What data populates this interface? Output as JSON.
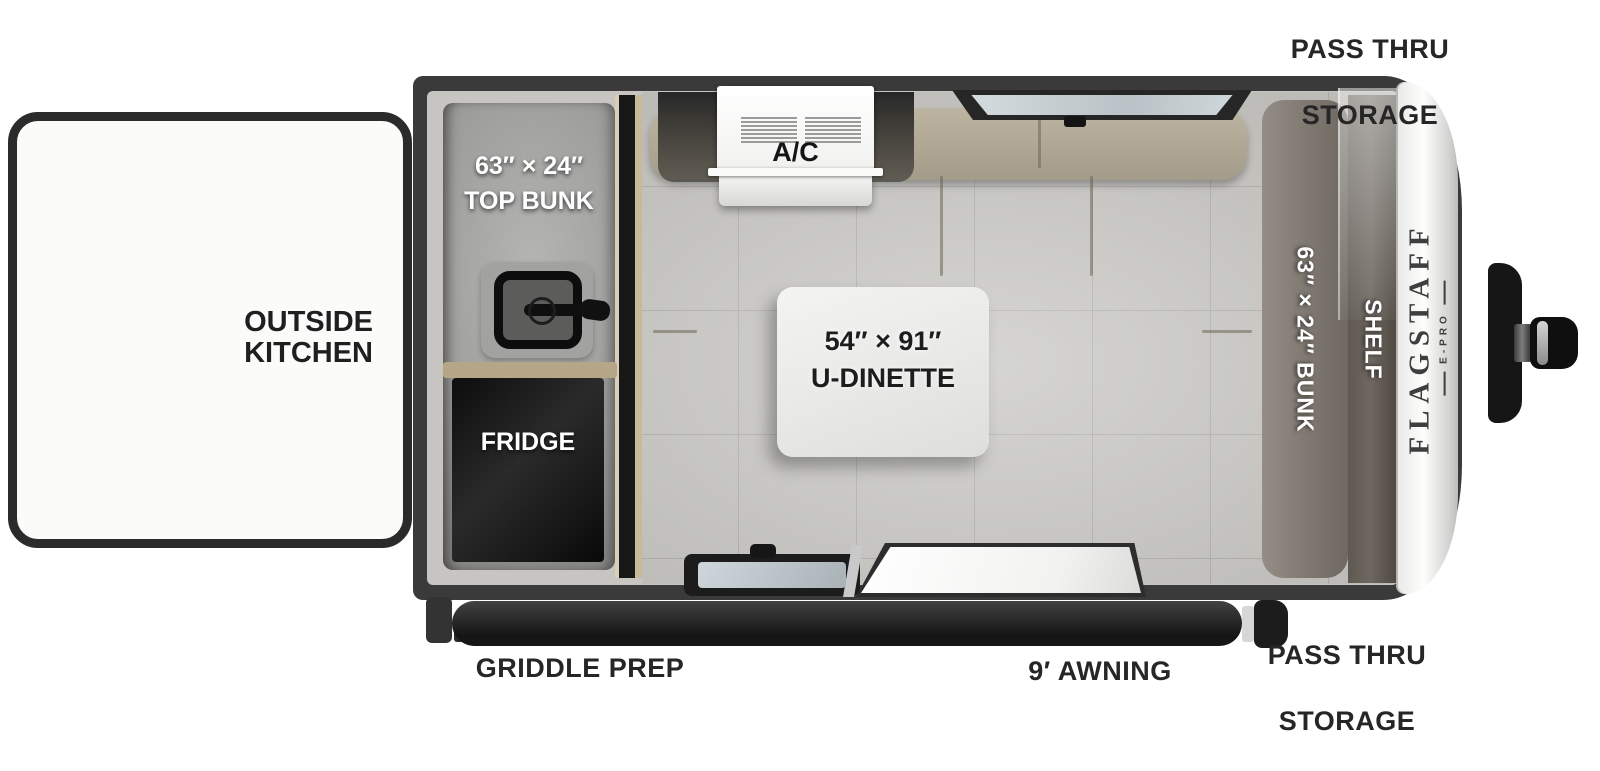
{
  "diagram": {
    "type": "rv-floorplan",
    "brand": {
      "name": "FLAGSTAFF",
      "model": "E-PRO"
    },
    "labels": {
      "pass_thru_top_l1": "PASS THRU",
      "pass_thru_top_l2": "STORAGE",
      "outside_kitchen_l1": "OUTSIDE",
      "outside_kitchen_l2": "KITCHEN",
      "top_bunk_l1": "63″ × 24″",
      "top_bunk_l2": "TOP BUNK",
      "fridge": "FRIDGE",
      "ac": "A/C",
      "dinette_l1": "54″ × 91″",
      "dinette_l2": "U-DINETTE",
      "rear_bunk": "63″ × 24″ BUNK",
      "shelf": "SHELF",
      "griddle_prep": "GRIDDLE PREP",
      "awning": "9′ AWNING",
      "pass_thru_bottom_l1": "PASS THRU",
      "pass_thru_bottom_l2": "STORAGE"
    },
    "colors": {
      "background": "#ffffff",
      "trailer_wall": "#3a3a3a",
      "interior_floor": "#c8c7c3",
      "sofa_tan": "#b3ab97",
      "fridge_black": "#141414",
      "table_white": "#ececea",
      "label_black": "#262626",
      "label_white": "#ffffff",
      "front_cap": "#e9e9e7"
    }
  }
}
